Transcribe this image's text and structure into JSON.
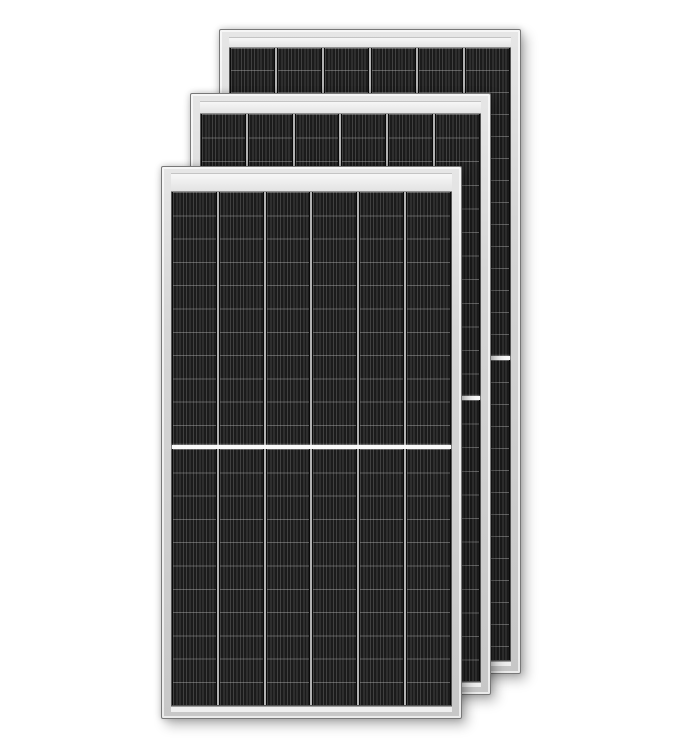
{
  "scene": {
    "description": "Product photo of three identical dark monocrystalline half-cut solar panels with silver aluminium frames, stacked with a diagonal offset on a plain white background",
    "background_color": "#ffffff",
    "panel_count": 3
  },
  "colors": {
    "bg": "#ffffff",
    "frame": "#d6d6d6",
    "frame_light": "#e6e6e6",
    "frame_dark": "#c7c7c7",
    "frame_edge": "#787878",
    "bar": "#e3e3e3",
    "bar_edge": "#8f8f8f",
    "cell_base": "#1b1b1b",
    "stripe": "#404040",
    "colgap": "#b2b2b2",
    "colgap_dark": "#0a0a0a",
    "rowline": "rgba(190,190,190,0.40)",
    "gap_white": "#fafafa",
    "strip_bottom": "#efefef"
  },
  "panels": [
    {
      "id": "back",
      "x": 219,
      "y": 29,
      "width": 302,
      "height": 645,
      "frame_top": 7,
      "frame_side": 9,
      "frame_bottom": 7,
      "top_bar_height": 9,
      "bottom_strip_height": 4,
      "columns": 6,
      "row_height": 22,
      "upper_fraction": 0.507,
      "center_gap_height": 4
    },
    {
      "id": "middle",
      "x": 190,
      "y": 93,
      "width": 301,
      "height": 602,
      "frame_top": 7,
      "frame_side": 9,
      "frame_bottom": 7,
      "top_bar_height": 11,
      "bottom_strip_height": 4,
      "columns": 6,
      "row_height": 23.6,
      "upper_fraction": 0.5,
      "center_gap_height": 4
    },
    {
      "id": "front",
      "x": 161,
      "y": 166,
      "width": 301,
      "height": 553,
      "frame_top": 6,
      "frame_side": 9,
      "frame_bottom": 6,
      "top_bar_height": 17,
      "bottom_strip_height": 5,
      "columns": 6,
      "row_height": 23.3,
      "upper_fraction": 0.498,
      "center_gap_height": 4
    }
  ]
}
